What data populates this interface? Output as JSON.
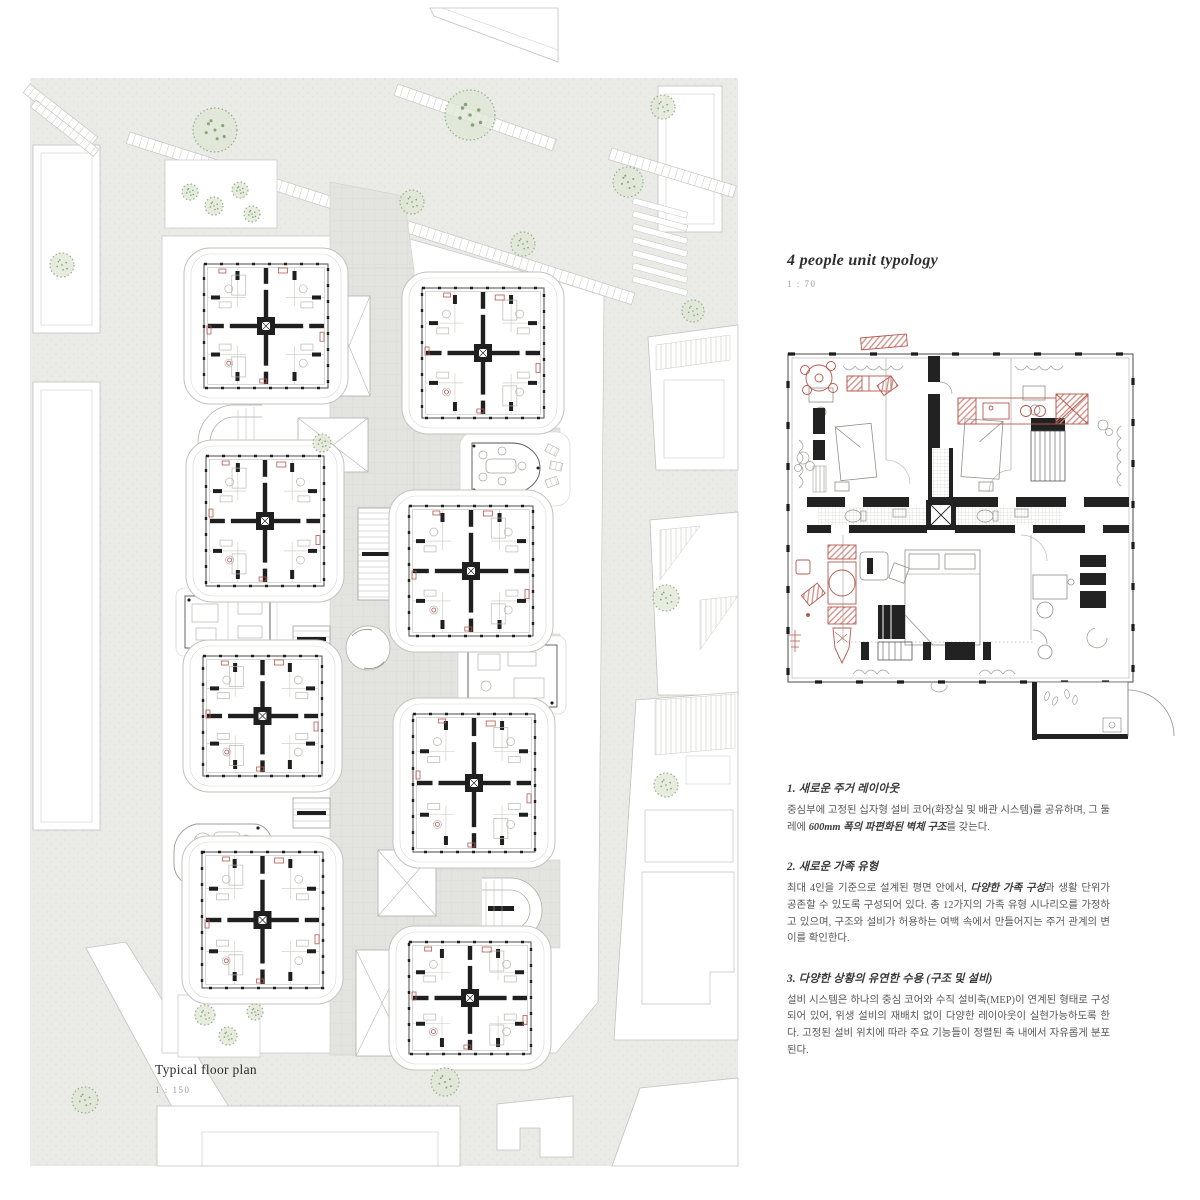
{
  "left_panel": {
    "caption_title": "Typical floor plan",
    "scale_label": "1 : 150"
  },
  "right_panel": {
    "title": "4 people unit typology",
    "scale_label": "1 : 70",
    "sections": [
      {
        "heading": "1. 새로운 주거 레이아웃",
        "body_pre": "중심부에 고정된 십자형 설비 코어(화장실 및 배관 시스템)를 공유하며, 그 둘레에 ",
        "body_bold": "600mm 폭의 파편화된 벽체 구조",
        "body_post": "를 갖는다."
      },
      {
        "heading": "2. 새로운 가족 유형",
        "body_pre": "최대 4인을 기준으로 설계된 평면 안에서, ",
        "body_bold": "다양한 가족 구성",
        "body_post": "과 생활 단위가 공존할 수 있도록 구성되어 있다. 총 12가지의 가족 유형 시나리오를 가정하고 있으며, 구조와 설비가 허용하는 여백 속에서 만들어지는 주거 관계의 변이를 확인한다."
      },
      {
        "heading": "3. 다양한 상황의 유연한 수용 (구조 및 설비)",
        "body_pre": "설비 시스템은 하나의 중심 코어와 수직 설비축(MEP)이 연계된 형태로 구성되어 있어, 위생 설비의 재배치 없이 다양한 레이아웃이 실현가능하도록 한다. 고정된 설비 위치에 따라 주요 기능들이 정렬된 축 내에서 자유롭게 분포된다.",
        "body_bold": "",
        "body_post": ""
      }
    ]
  },
  "colors": {
    "road_gray": "#eaebe7",
    "plaza_gray": "#e3e4e0",
    "outline_gray": "#c2c2bf",
    "wall_black": "#1f1f1f",
    "accent_red": "#b5584e",
    "red_fill": "#e7c0ba",
    "tree_green": "#94b087",
    "tree_fill": "#dde7d4"
  },
  "site_plan": {
    "units": [
      [
        204,
        264,
        124,
        124
      ],
      [
        422,
        288,
        122,
        130
      ],
      [
        206,
        456,
        118,
        130
      ],
      [
        409,
        506,
        124,
        130
      ],
      [
        203,
        656,
        119,
        120
      ],
      [
        413,
        714,
        122,
        138
      ],
      [
        202,
        852,
        121,
        136
      ],
      [
        409,
        942,
        122,
        112
      ]
    ],
    "trees": [
      [
        215,
        130,
        22
      ],
      [
        62,
        265,
        12
      ],
      [
        412,
        202,
        12
      ],
      [
        470,
        115,
        25
      ],
      [
        523,
        244,
        12
      ],
      [
        628,
        182,
        15
      ],
      [
        663,
        107,
        12
      ],
      [
        693,
        311,
        11
      ],
      [
        666,
        598,
        13
      ],
      [
        666,
        785,
        12
      ],
      [
        85,
        1100,
        13
      ],
      [
        445,
        1082,
        14
      ],
      [
        205,
        1015,
        10
      ],
      [
        228,
        1036,
        9
      ],
      [
        255,
        1012,
        8
      ],
      [
        322,
        443,
        9
      ],
      [
        190,
        192,
        8
      ],
      [
        214,
        206,
        9
      ],
      [
        240,
        190,
        8
      ],
      [
        252,
        214,
        8
      ]
    ],
    "skylights": [
      [
        328,
        296,
        42,
        100
      ],
      [
        298,
        418,
        70,
        54
      ],
      [
        378,
        850,
        58,
        66
      ],
      [
        356,
        950,
        52,
        106
      ]
    ],
    "stairlets": [
      [
        293,
        626,
        37,
        26
      ],
      [
        293,
        798,
        37,
        30
      ],
      [
        358,
        508,
        62,
        92
      ]
    ]
  }
}
